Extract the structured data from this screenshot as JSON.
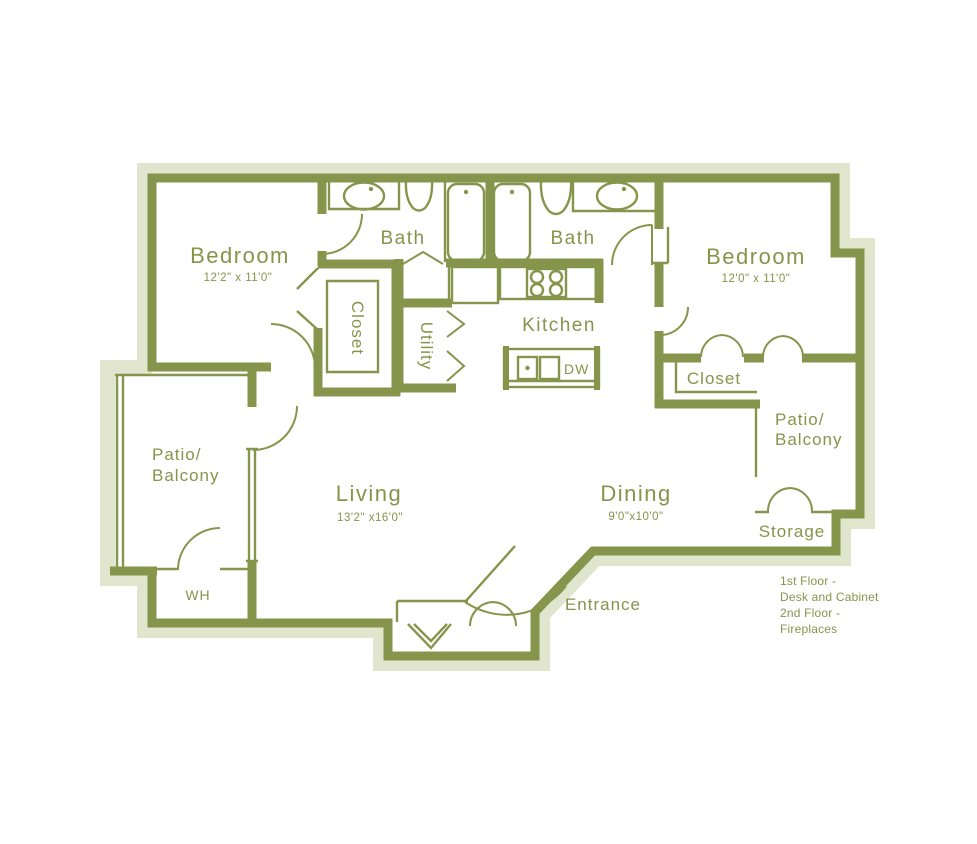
{
  "rooms": {
    "bedroom_left": {
      "label": "Bedroom",
      "dimensions": "12'2\" x 11'0\""
    },
    "bedroom_right": {
      "label": "Bedroom",
      "dimensions": "12'0\" x 11'0\""
    },
    "bath_left": {
      "label": "Bath"
    },
    "bath_right": {
      "label": "Bath"
    },
    "kitchen": {
      "label": "Kitchen"
    },
    "living": {
      "label": "Living",
      "dimensions": "13'2\" x16'0\""
    },
    "dining": {
      "label": "Dining",
      "dimensions": "9'0\"x10'0\""
    },
    "closet_left": {
      "label": "Closet"
    },
    "closet_right": {
      "label": "Closet"
    },
    "utility": {
      "label": "Utility"
    },
    "patio_left": {
      "label_line1": "Patio/",
      "label_line2": "Balcony"
    },
    "patio_right": {
      "label_line1": "Patio/",
      "label_line2": "Balcony"
    },
    "water_heater": {
      "label": "WH"
    },
    "storage": {
      "label": "Storage"
    },
    "entrance": {
      "label": "Entrance"
    }
  },
  "appliances": {
    "dishwasher_label": "DW"
  },
  "notes": {
    "line1": "1st Floor -",
    "line2": "Desk and Cabinet",
    "line3": "2nd Floor -",
    "line4": "Fireplaces"
  },
  "colors": {
    "wall": "#87944b",
    "text": "#87944b",
    "halo": "#e1e5cd",
    "background": "#ffffff"
  }
}
